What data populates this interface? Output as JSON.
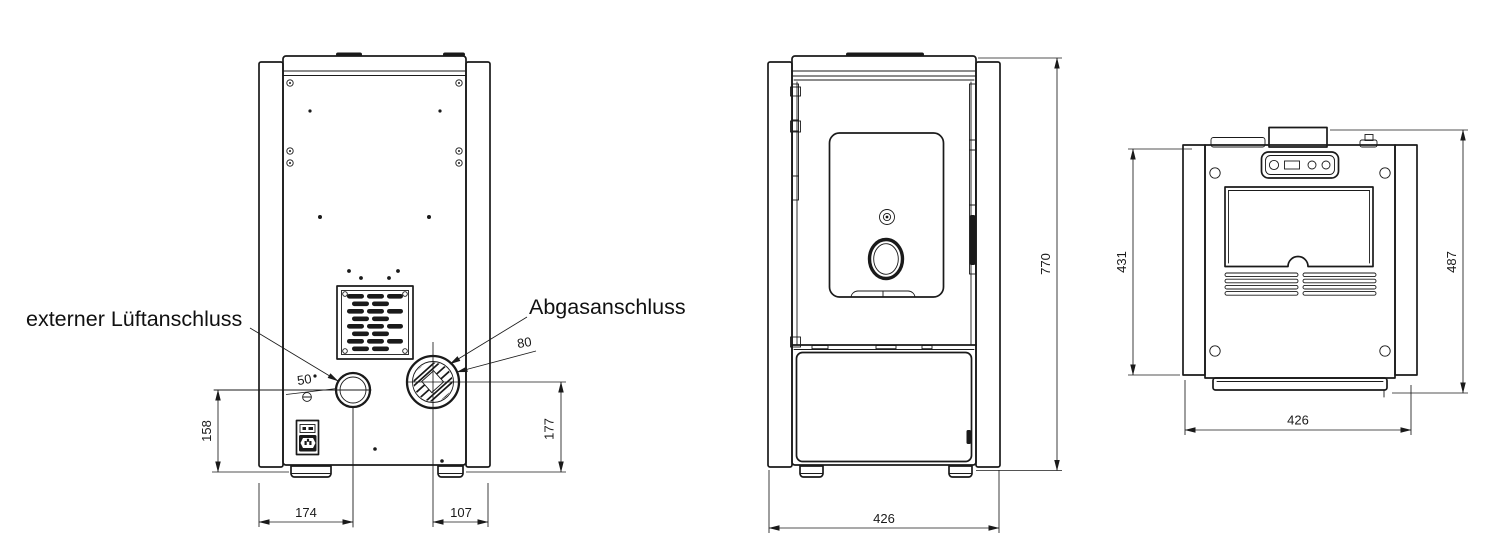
{
  "drawing": {
    "type": "technical-drawing",
    "subject": "pellet stove three-view dimensional drawing",
    "views": [
      "rear",
      "front",
      "top"
    ],
    "colors": {
      "line": "#1a1a1a",
      "background": "#ffffff"
    }
  },
  "labels": {
    "air_connection": "externer Lüftanschluss",
    "exhaust_connection": "Abgasanschluss"
  },
  "dimensions": {
    "air_diameter": "50",
    "exhaust_diameter": "80",
    "air_center_height": "158",
    "exhaust_center_height": "177",
    "air_center_from_left": "174",
    "exhaust_center_from_right": "107",
    "overall_height": "770",
    "front_width": "426",
    "body_depth": "431",
    "overall_depth": "487",
    "top_width": "426"
  }
}
